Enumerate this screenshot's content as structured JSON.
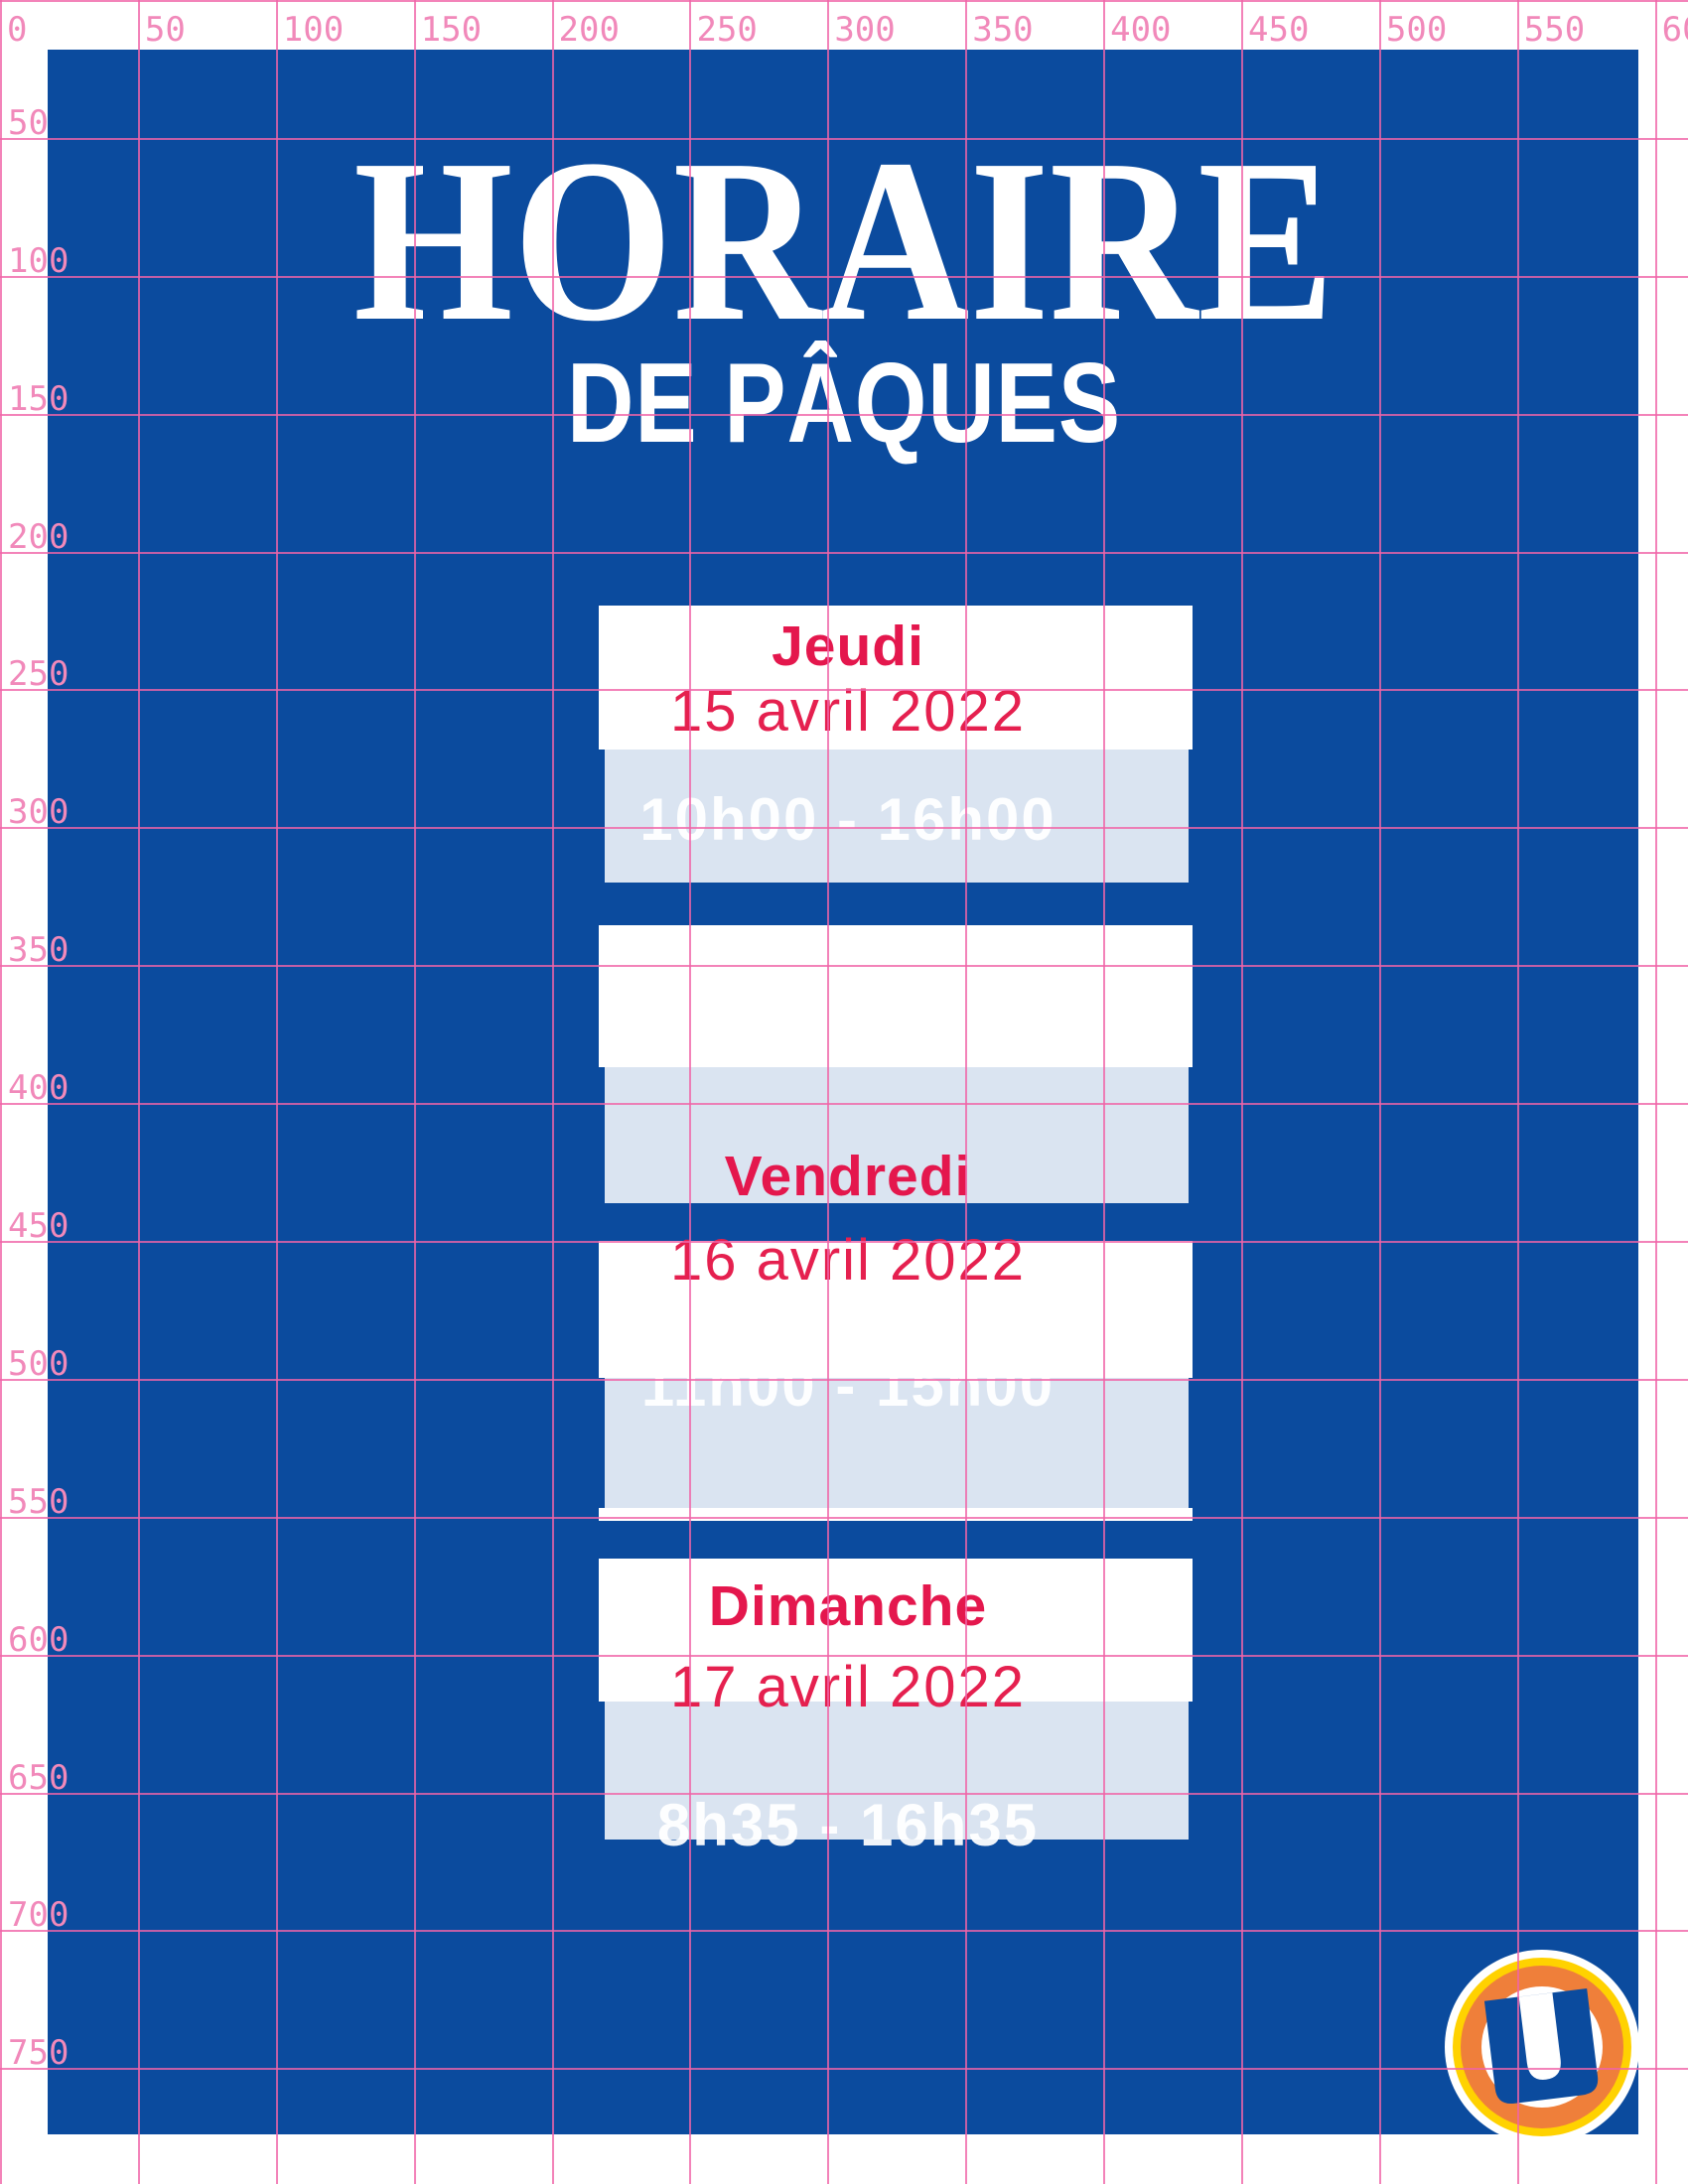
{
  "poster": {
    "title_line1": "HORAIRE",
    "title_line2": "DE PÂQUES",
    "schedule": [
      {
        "day": "Jeudi",
        "date": "15 avril 2022",
        "hours": "10h00 - 16h00"
      },
      {
        "day": "Vendredi",
        "date": "16 avril 2022",
        "hours": "11h00 - 15h00"
      },
      {
        "day": "Dimanche",
        "date": "17 avril 2022",
        "hours": "8h35 - 16h35"
      }
    ],
    "logo_letter": "U"
  },
  "ruler": {
    "top": [
      "0",
      "50",
      "100",
      "150",
      "200",
      "250",
      "300",
      "350",
      "400",
      "450",
      "500",
      "550",
      "600"
    ],
    "left": [
      "50",
      "100",
      "150",
      "200",
      "250",
      "300",
      "350",
      "400",
      "450",
      "500",
      "550",
      "600",
      "650",
      "700",
      "750"
    ]
  },
  "colors": {
    "poster_blue": "#0b4b9e",
    "band_blue": "#dce4f1",
    "accent_red": "#e4174d",
    "grid_pink": "#f064a8",
    "ruler_label_pink": "#f189ba",
    "logo_orange": "#ef7f3a",
    "logo_yellow": "#ffd200",
    "text_white": "#ffffff"
  }
}
